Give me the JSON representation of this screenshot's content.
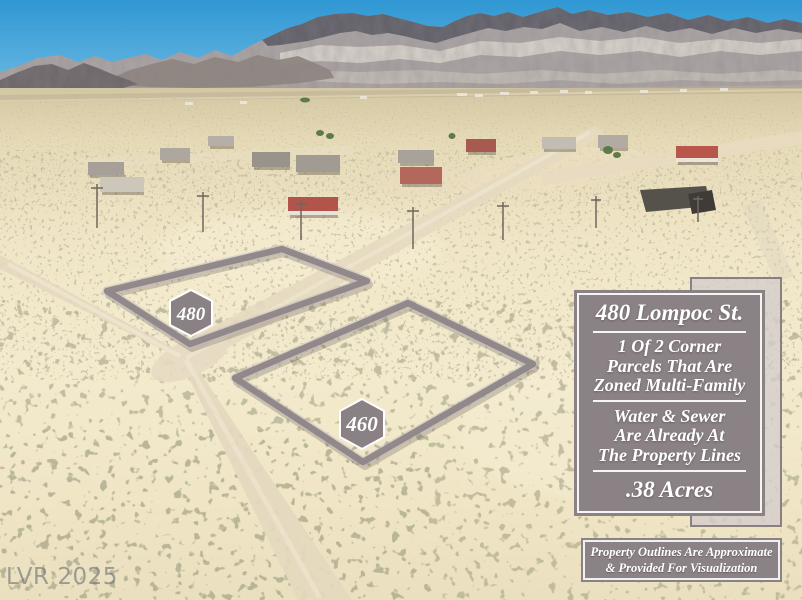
{
  "watermark": "LVR 2025",
  "parcels": [
    {
      "label": "480"
    },
    {
      "label": "460"
    }
  ],
  "info_panel": {
    "title": "480 Lompoc St.",
    "zoning": [
      "1 Of 2 Corner",
      "Parcels That Are",
      "Zoned Multi-Family"
    ],
    "utilities": [
      "Water & Sewer",
      "Are Already At",
      "The Property Lines"
    ],
    "acreage": ".38 Acres"
  },
  "disclaimer": [
    "Property Outlines Are Approximate",
    "& Provided For Visualization"
  ],
  "colors": {
    "panel_gray": "#8b8285",
    "outline_gray": "#8f8689",
    "badge_gray": "#8a8185",
    "sky_blue": "#2f97d3",
    "desert_cream": "#f0e6c7"
  }
}
